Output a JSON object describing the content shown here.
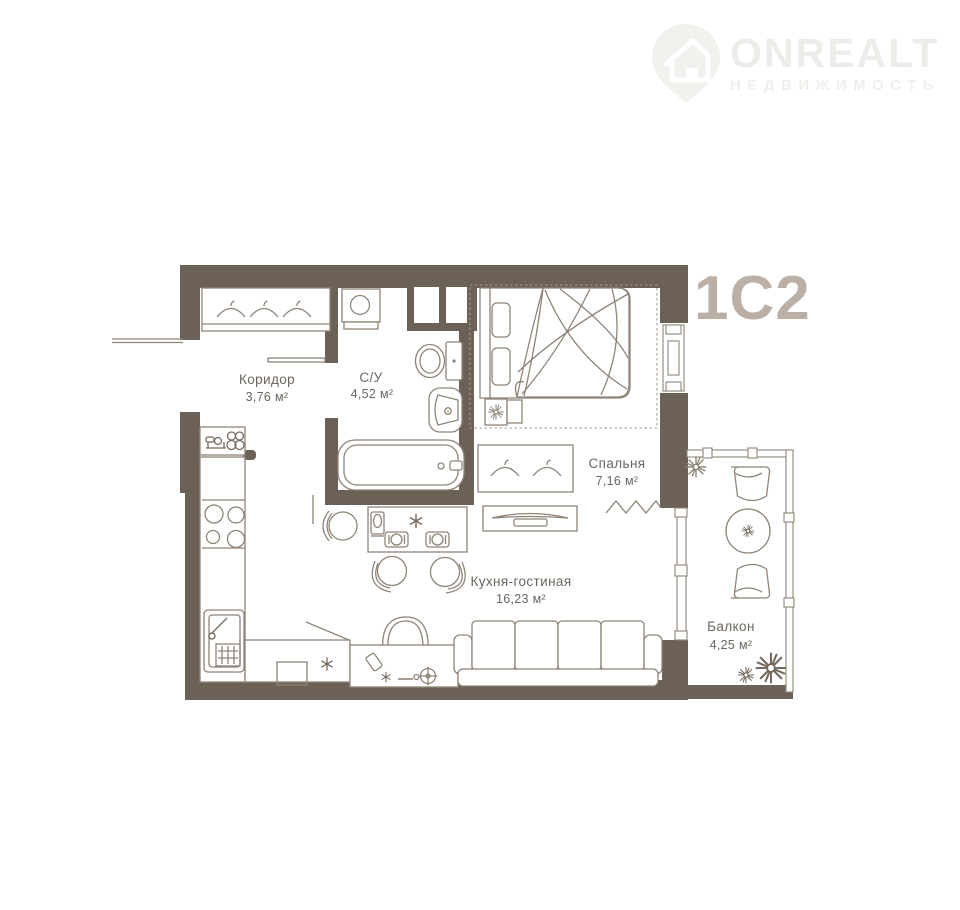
{
  "logo": {
    "brand": "ONREALT",
    "subtitle": "НЕДВИЖИМОСТЬ",
    "icon": "house-pin-icon"
  },
  "plan": {
    "unit_label": "1С2",
    "rooms": [
      {
        "id": "hallway",
        "name": "Коридор",
        "area": "3,76 м²"
      },
      {
        "id": "bathroom",
        "name": "С/У",
        "area": "4,52 м²"
      },
      {
        "id": "bedroom",
        "name": "Спальня",
        "area": "7,16 м²"
      },
      {
        "id": "kitchen-living",
        "name": "Кухня-гостиная",
        "area": "16,23 м²"
      },
      {
        "id": "balcony",
        "name": "Балкон",
        "area": "4,25 м²"
      }
    ],
    "colors": {
      "wall": "#6c6156",
      "furniture_line": "#8e8478",
      "room_label": "#6b655e",
      "unit_label": "#bcb0a6",
      "logo": "#eeece9",
      "background": "#ffffff"
    }
  }
}
